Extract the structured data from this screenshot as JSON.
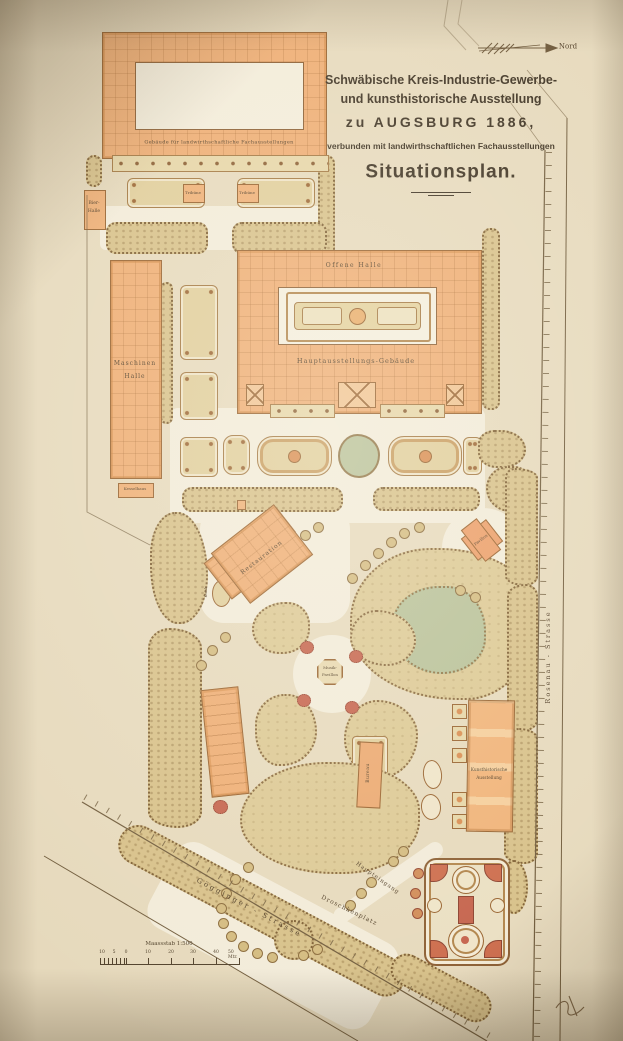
{
  "map": {
    "title": {
      "line1": "Schwäbische Kreis-Industrie-Gewerbe-",
      "line2": "und kunsthistorische Ausstellung",
      "line3": "zu AUGSBURG 1886,",
      "line4": "verbunden mit landwirthschaftlichen Fachausstellungen",
      "line5": "Situationsplan."
    },
    "compass": "Nord",
    "buildings": {
      "fachausstellungen": "Gebäude für landwirthschaftliche Fachausstellungen",
      "tribuene": "Tribüne",
      "bierhalle_line1": "Bier-",
      "bierhalle_line2": "Halle",
      "maschinenhalle_line1": "Maschinen",
      "maschinenhalle_line2": "Halle",
      "offene_halle": "Offene Halle",
      "hauptgebaeude": "Hauptausstellungs-Gebäude",
      "kesselhaus": "Kesselhaus",
      "kiosk": "Kiosk",
      "restauration": "Restauration",
      "pavillon": "Pavillon",
      "musikpavillon_line1": "Musik-",
      "musikpavillon_line2": "Pavillon",
      "bureau": "Bureau",
      "kunsthistorische_line1": "Kunsthistorische",
      "kunsthistorische_line2": "Ausstellung"
    },
    "places": {
      "haupteingang": "Haupteingang",
      "droschkenplatz": "Droschkenplatz"
    },
    "streets": {
      "goegginger": "Gögginger  -  Strasse",
      "rosenau": "Rosenau  -  Strasse"
    },
    "scale": {
      "caption": "Maassstab 1:500",
      "ticks": [
        "10",
        "5",
        "0",
        "10",
        "20",
        "30",
        "40",
        "50 Mtr."
      ]
    }
  },
  "colors": {
    "paper": "#e6d9bc",
    "building_orange": "#eeac72",
    "hedge_tan": "#d7c088",
    "pond_green": "#b7c097",
    "accent_red": "#c4614a",
    "ink": "#4e3b24"
  }
}
